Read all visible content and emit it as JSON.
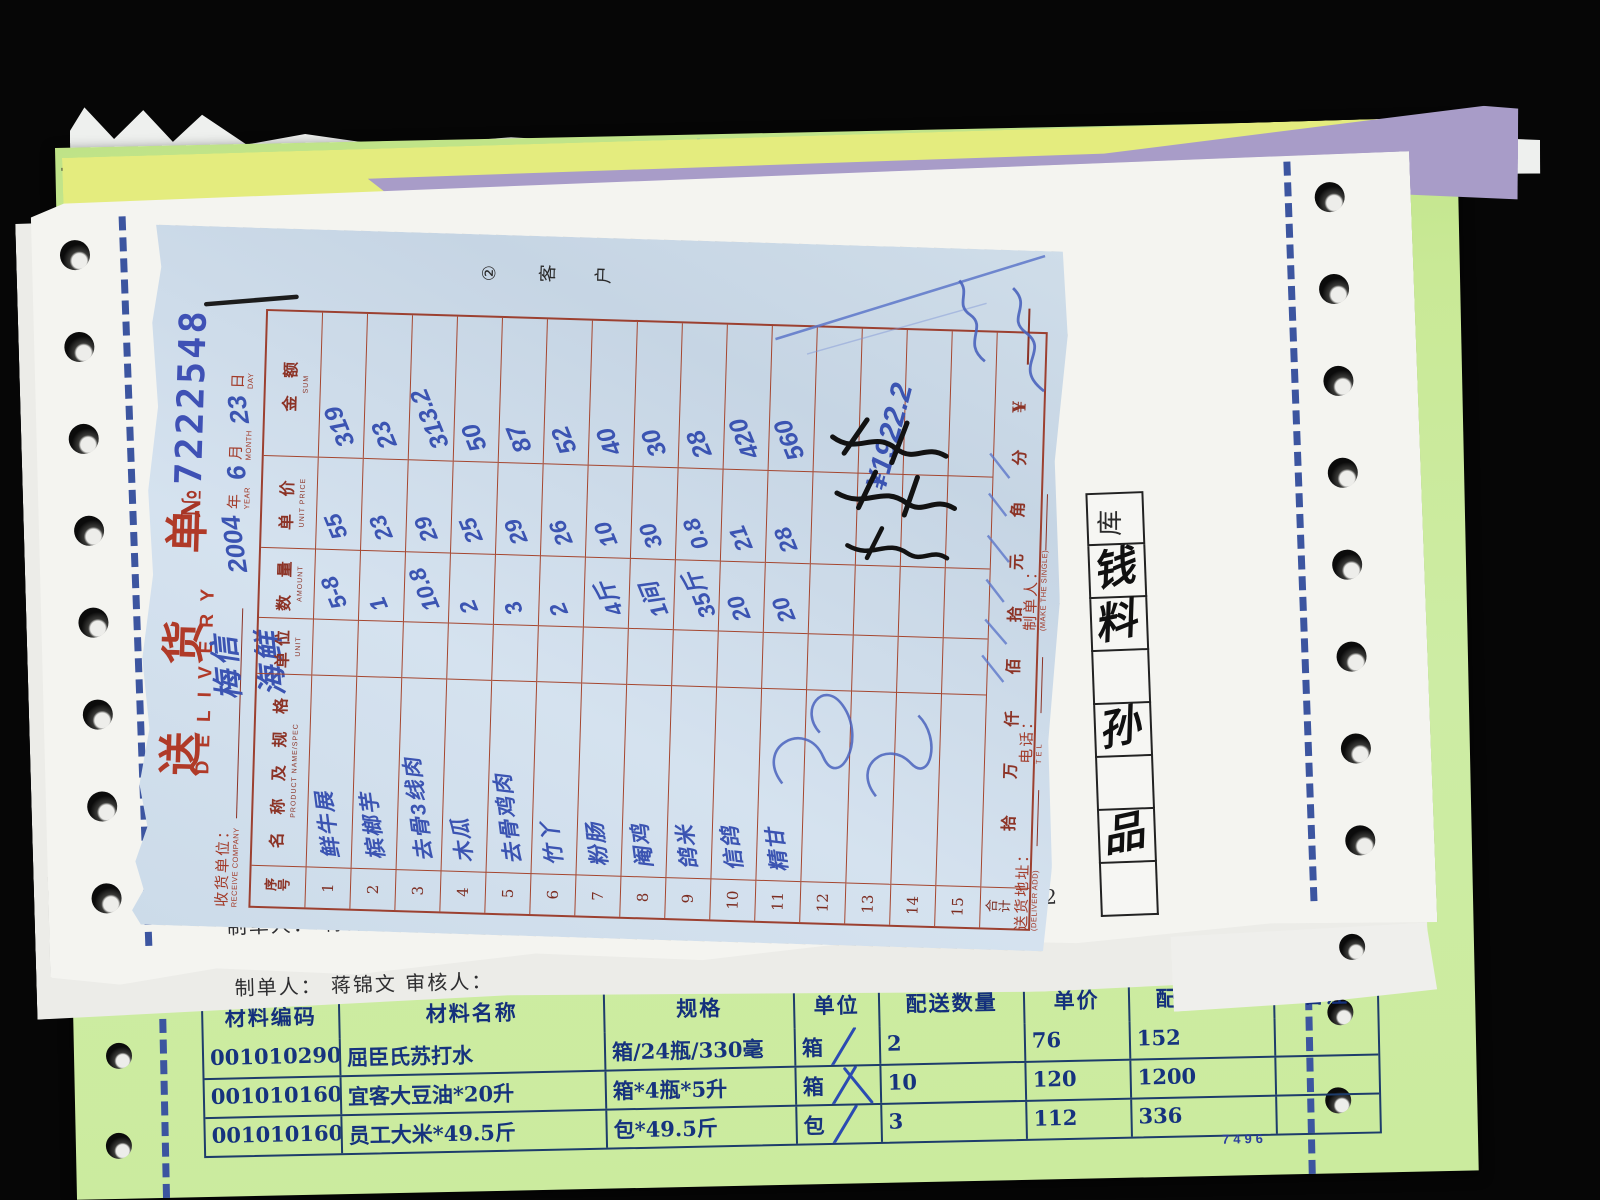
{
  "colors": {
    "ink_blue": "#3b54b2",
    "print_red": "#a23a28",
    "paper_blue": "#cfdde9",
    "paper_green": "#c9e996",
    "paper_yellow": "#e4ec7e",
    "paper_purple": "#a89cc8",
    "green_table_blue": "#1d3c6b"
  },
  "delivery_note": {
    "title_cn": "送 货 单",
    "title_en": "DELIVERY",
    "no_prefix": "№",
    "no": "7222548",
    "copy_tag": "② 客 户",
    "receive_company_label": "收货单位：",
    "receive_company_en": "RECEIVE COMPANY",
    "receive_company_value": "梅信海鲜",
    "date": {
      "year": "2004",
      "year_label": "年",
      "year_en": "YEAR",
      "month": "6",
      "month_label": "月",
      "month_en": "MONTH",
      "day": "23",
      "day_label": "日",
      "day_en": "DAY"
    },
    "columns": [
      {
        "cn": "序号",
        "en": ""
      },
      {
        "cn": "名 称 及 规 格",
        "en": "PRODUCT NAME/SPEC"
      },
      {
        "cn": "单位",
        "en": "UNIT"
      },
      {
        "cn": "数 量",
        "en": "AMOUNT"
      },
      {
        "cn": "单 价",
        "en": "UNIT PRICE"
      },
      {
        "cn": "金 额",
        "en": "SUM"
      }
    ],
    "rows": [
      {
        "no": "1",
        "name": "鲜牛展",
        "unit": "",
        "amount": "5-8",
        "price": "55",
        "sum": "319"
      },
      {
        "no": "2",
        "name": "槟榔芋",
        "unit": "",
        "amount": "1",
        "price": "23",
        "sum": "23"
      },
      {
        "no": "3",
        "name": "去骨3线肉",
        "unit": "",
        "amount": "10.8",
        "price": "29",
        "sum": "313.2"
      },
      {
        "no": "4",
        "name": "木瓜",
        "unit": "",
        "amount": "2",
        "price": "25",
        "sum": "50"
      },
      {
        "no": "5",
        "name": "去骨鸡肉",
        "unit": "",
        "amount": "3",
        "price": "29",
        "sum": "87"
      },
      {
        "no": "6",
        "name": "竹丫",
        "unit": "",
        "amount": "2",
        "price": "26",
        "sum": "52"
      },
      {
        "no": "7",
        "name": "粉肠",
        "unit": "",
        "amount": "4斤",
        "price": "10",
        "sum": "40"
      },
      {
        "no": "8",
        "name": "阉鸡",
        "unit": "",
        "amount": "1间",
        "price": "30",
        "sum": "30"
      },
      {
        "no": "9",
        "name": "鸽米",
        "unit": "",
        "amount": "35斤",
        "price": "0.8",
        "sum": "28"
      },
      {
        "no": "10",
        "name": "信鸽",
        "unit": "",
        "amount": "20",
        "price": "21",
        "sum": "420"
      },
      {
        "no": "11",
        "name": "精甘",
        "unit": "",
        "amount": "20",
        "price": "28",
        "sum": "560"
      },
      {
        "no": "12",
        "name": "",
        "unit": "",
        "amount": "",
        "price": "",
        "sum": ""
      },
      {
        "no": "13",
        "name": "",
        "unit": "",
        "amount": "",
        "price": "",
        "sum": ""
      },
      {
        "no": "14",
        "name": "",
        "unit": "",
        "amount": "",
        "price": "",
        "sum": ""
      },
      {
        "no": "15",
        "name": "",
        "unit": "",
        "amount": "",
        "price": "",
        "sum": ""
      }
    ],
    "total_row": {
      "label": "合计",
      "words": [
        "拾",
        "万",
        "仟",
        "佰",
        "拾",
        "元",
        "角",
        "分"
      ],
      "currency": "¥"
    },
    "handwritten_total": "¥1922.2",
    "footer": {
      "addr_cn": "送货地址：",
      "addr_en": "(DELIVER ADD)",
      "tel_cn": "电话：",
      "tel_en": "T E L",
      "maker_cn": "制单人：",
      "maker_en": "(MAKE THE SINGLE)"
    }
  },
  "white_sheet": {
    "maker_line": {
      "maker_label": "制单人：",
      "maker": "蒋锦文",
      "auditor_label": "审核人：",
      "sign_label": "主管签名：",
      "total_label": "总金额：",
      "total": "1922.2"
    },
    "second_line": "制单人： 蒋锦文      审核人：",
    "box_header": "库",
    "box_chars": [
      "",
      "钱",
      "料",
      "",
      "孙",
      "",
      "品",
      ""
    ],
    "tick_marks": "≡"
  },
  "green_sheet": {
    "store_title": "门店配送单",
    "serial": "7496",
    "table": {
      "headers": [
        "材料编码",
        "材料名称",
        "规格",
        "单位",
        "配送数量",
        "单价",
        "配送金额",
        "备注"
      ],
      "rows": [
        {
          "code": "00101029017",
          "name": "屈臣氏苏打水",
          "spec": "箱/24瓶/330毫",
          "unit": "箱",
          "qty": "2",
          "price": "76",
          "amount": "152",
          "remark": "",
          "slash": "single"
        },
        {
          "code": "00101016086",
          "name": "宜客大豆油*20升",
          "spec": "箱*4瓶*5升",
          "unit": "箱",
          "qty": "10",
          "price": "120",
          "amount": "1200",
          "remark": "",
          "slash": "cross"
        },
        {
          "code": "00101016097",
          "name": "员工大米*49.5斤",
          "spec": "包*49.5斤",
          "unit": "包",
          "qty": "3",
          "price": "112",
          "amount": "336",
          "remark": "",
          "slash": "single"
        }
      ]
    }
  }
}
